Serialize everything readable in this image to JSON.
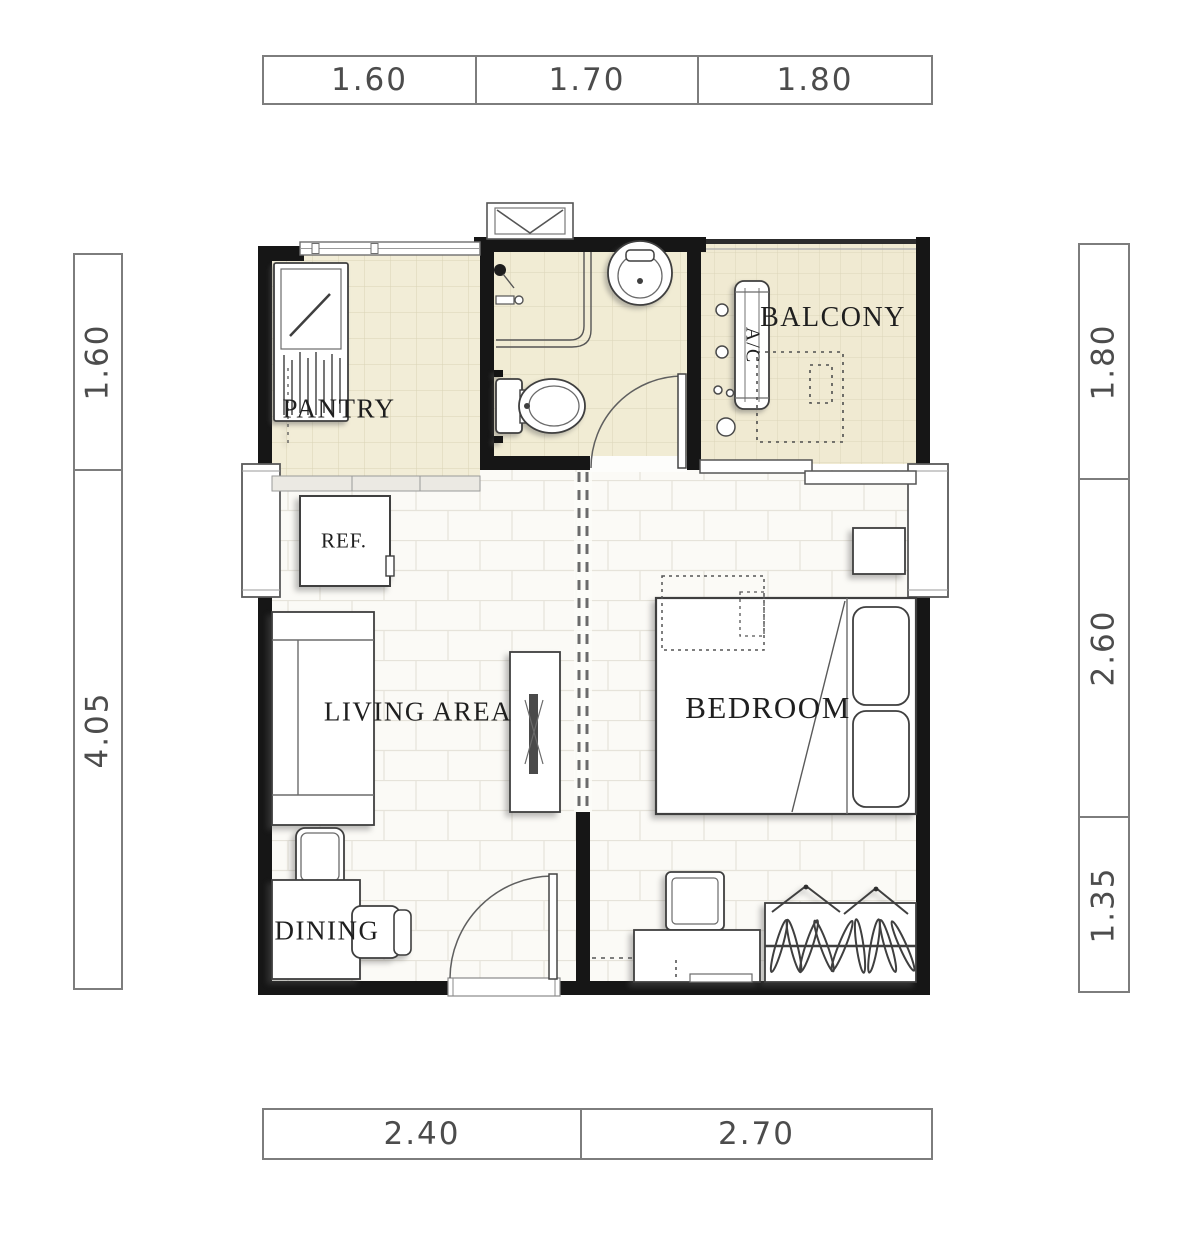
{
  "room_labels": {
    "pantry": "PANTRY",
    "balcony": "BALCONY",
    "living_area": "LIVING AREA",
    "bedroom": "BEDROOM",
    "dining": "DINING",
    "refrigerator": "REF.",
    "air_conditioner": "A/C"
  },
  "dimensions": {
    "top": [
      "1.60",
      "1.70",
      "1.80"
    ],
    "bottom": [
      "2.40",
      "2.70"
    ],
    "left": [
      "1.60",
      "4.05"
    ],
    "right": [
      "1.80",
      "2.60",
      "1.35"
    ]
  },
  "colors": {
    "wall": "#161616",
    "tile_floor": "#f2edd7",
    "tile_line": "#d9d3b6",
    "plank_floor": "#fbfaf6",
    "plank_line": "#e6e3da",
    "furniture_outline": "#3f3f3f",
    "dimension_border": "#7d7d7d",
    "dimension_text": "#4c4c4c"
  }
}
